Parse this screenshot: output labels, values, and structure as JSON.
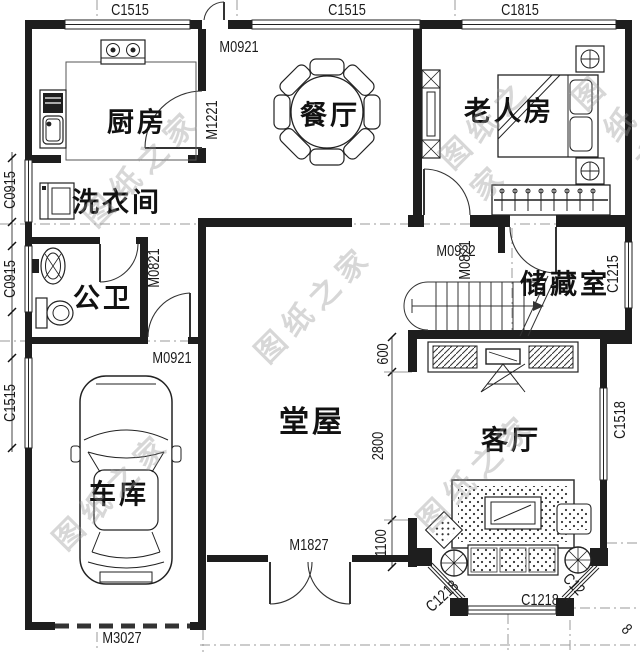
{
  "watermark": {
    "text": "图纸之家"
  },
  "rooms": {
    "kitchen": "厨房",
    "dining": "餐厅",
    "elder_bedroom": "老人房",
    "laundry": "洗衣间",
    "bathroom": "公卫",
    "storage": "储藏室",
    "hall": "堂屋",
    "living": "客厅",
    "garage": "车库"
  },
  "openings": {
    "top_left_window": "C1515",
    "top_mid_window": "C1515",
    "top_right_window": "C1815",
    "top_door": "M0921",
    "kitchen_door": "M1221",
    "laundry_window": "C0915",
    "bathroom_window": "C0915",
    "garage_window": "C1515",
    "bathroom_door": "M0821",
    "hall_side_door": "M0921",
    "bedroom_door": "M0922",
    "storage_door": "M0821",
    "storage_window": "C1215",
    "living_window": "C1518",
    "front_door": "M1827",
    "garage_door": "M3027",
    "bay_window_front": "C1218",
    "bay_window_left": "C1218",
    "bay_window_right": "C12",
    "bay_window_right_tail": "8"
  },
  "dimensions": {
    "top": "600",
    "middle": "2800",
    "bottom": "1100"
  }
}
